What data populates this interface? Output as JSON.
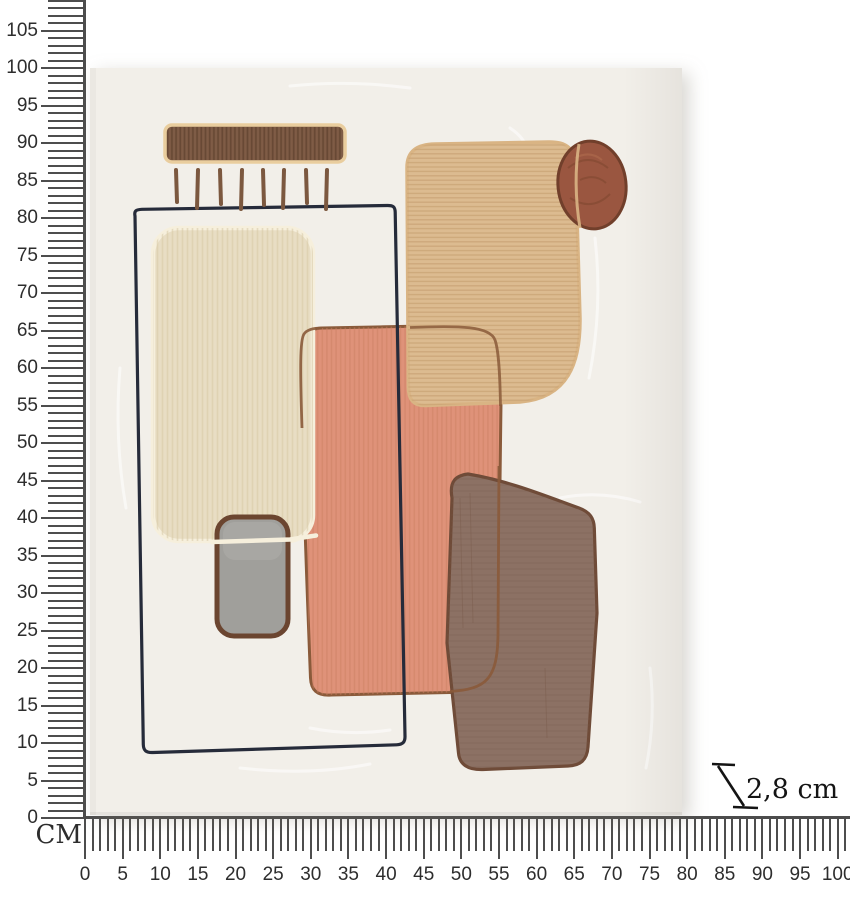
{
  "rulers": {
    "unit_label": "CM",
    "vertical": {
      "labels": [
        105,
        100,
        95,
        90,
        85,
        80,
        75,
        70,
        65,
        60,
        55,
        50,
        45,
        40,
        35,
        30,
        25,
        20,
        15,
        10,
        5,
        0
      ],
      "px_per_cm": 7.5,
      "origin_y": 818,
      "minor_tick_count": 110
    },
    "horizontal": {
      "labels": [
        0,
        5,
        10,
        15,
        20,
        25,
        30,
        35,
        40,
        45,
        50,
        55,
        60,
        65,
        70,
        75,
        80,
        85,
        90,
        95,
        100
      ],
      "px_per_cm": 7.527,
      "origin_x": 85,
      "minor_tick_count": 102
    }
  },
  "depth_annotation": {
    "text": "2,8 cm"
  },
  "colors": {
    "page_bg": "#ffffff",
    "ruler_line": "#4d4d4d",
    "ruler_text": "#2d2d2d",
    "depth_text": "#141414",
    "canvas_bg": "#f2efe9",
    "canvas_edge": "#e8e5de",
    "bar_fill": "#7f5c46",
    "bar_stripe": "#634530",
    "bar_border": "#e9cd9e",
    "fringe": "#7c583f",
    "frame_navy": "#262b3a",
    "cream_fill": "#e8ddc4",
    "cream_stripe": "#d7c9a5",
    "cream_border": "#f6efdc",
    "tan_fill": "#dcbb90",
    "tan_stripe": "#c9a172",
    "tan_border": "#d9b484",
    "salmon_fill": "#df9279",
    "salmon_stripe": "#cb7f62",
    "salmon_border": "#8a5a3a",
    "circle_fill": "#9a5640",
    "circle_border": "#713f2b",
    "circle_swirl": "#7d462f",
    "circle_highlight": "#b06d4e",
    "gray_fill": "#a09f9b",
    "gray_light": "#aeada9",
    "gray_border": "#6b4530",
    "taupe_fill": "#8c7164",
    "taupe_stripe": "#77594a",
    "taupe_border": "#6f4b38"
  }
}
